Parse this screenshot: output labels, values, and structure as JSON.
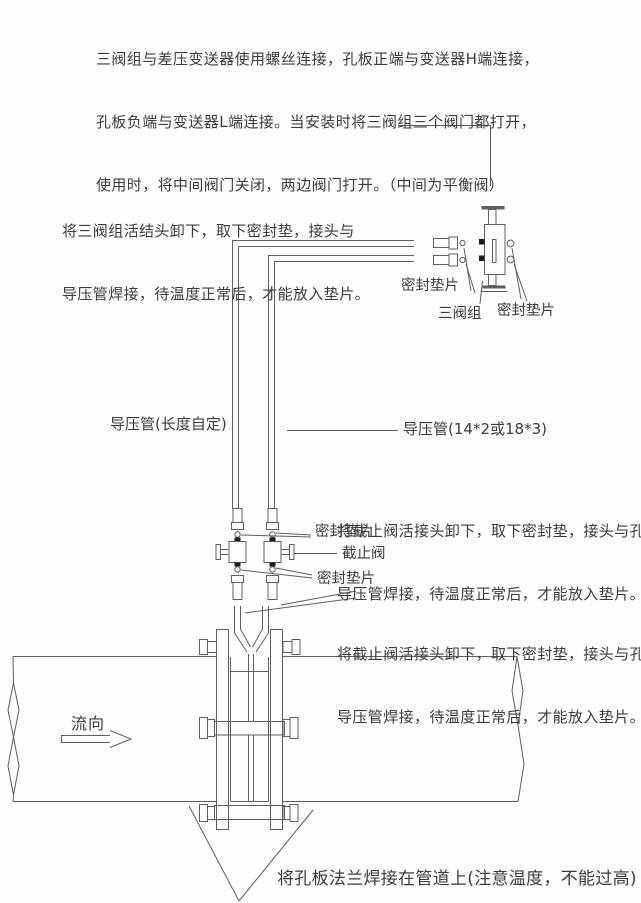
{
  "instructions": {
    "top_paragraph": {
      "line1": "三阀组与差压变送器使用螺丝连接，孔板正端与变送器H端连接，",
      "line2": "孔板负端与变送器L端连接。当安装时将三阀组三个阀门都打开，",
      "line3": "使用时，将中间阀门关闭，两边阀门打开。（中间为平衡阀）"
    },
    "manifold_note": {
      "line1": "将三阀组活结头卸下，取下密封垫，接头与",
      "line2": "导压管焊接，待温度正常后，才能放入垫片。"
    },
    "stop_valve_note_upper": {
      "line1": "将截止阀活接头卸下，取下密封垫，接头与孔板",
      "line2": "导压管焊接，待温度正常后，才能放入垫片。"
    },
    "stop_valve_note_lower": {
      "line1": "将截止阀活接头卸下，取下密封垫，接头与孔板",
      "line2": "导压管焊接，待温度正常后，才能放入垫片。"
    },
    "bottom_note": "将孔板法兰焊接在管道上(注意温度，不能过高)"
  },
  "labels": {
    "seal_gasket_manifold_left": "密封垫片",
    "three_valve_manifold": "三阀组",
    "seal_gasket_manifold_right": "密封垫片",
    "impulse_pipe_left": "导压管(长度自定)",
    "impulse_pipe_right": "导压管(14*2或18*3)",
    "seal_gasket_valve_top": "密封垫片",
    "stop_valve": "截止阀",
    "seal_gasket_valve_bottom": "密封垫片",
    "flow_direction": "流向"
  },
  "colors": {
    "line": "#5f5f5f",
    "text": "#3c3c3c",
    "background": "#fcfdfe",
    "black_fill": "#1c1c1c"
  }
}
